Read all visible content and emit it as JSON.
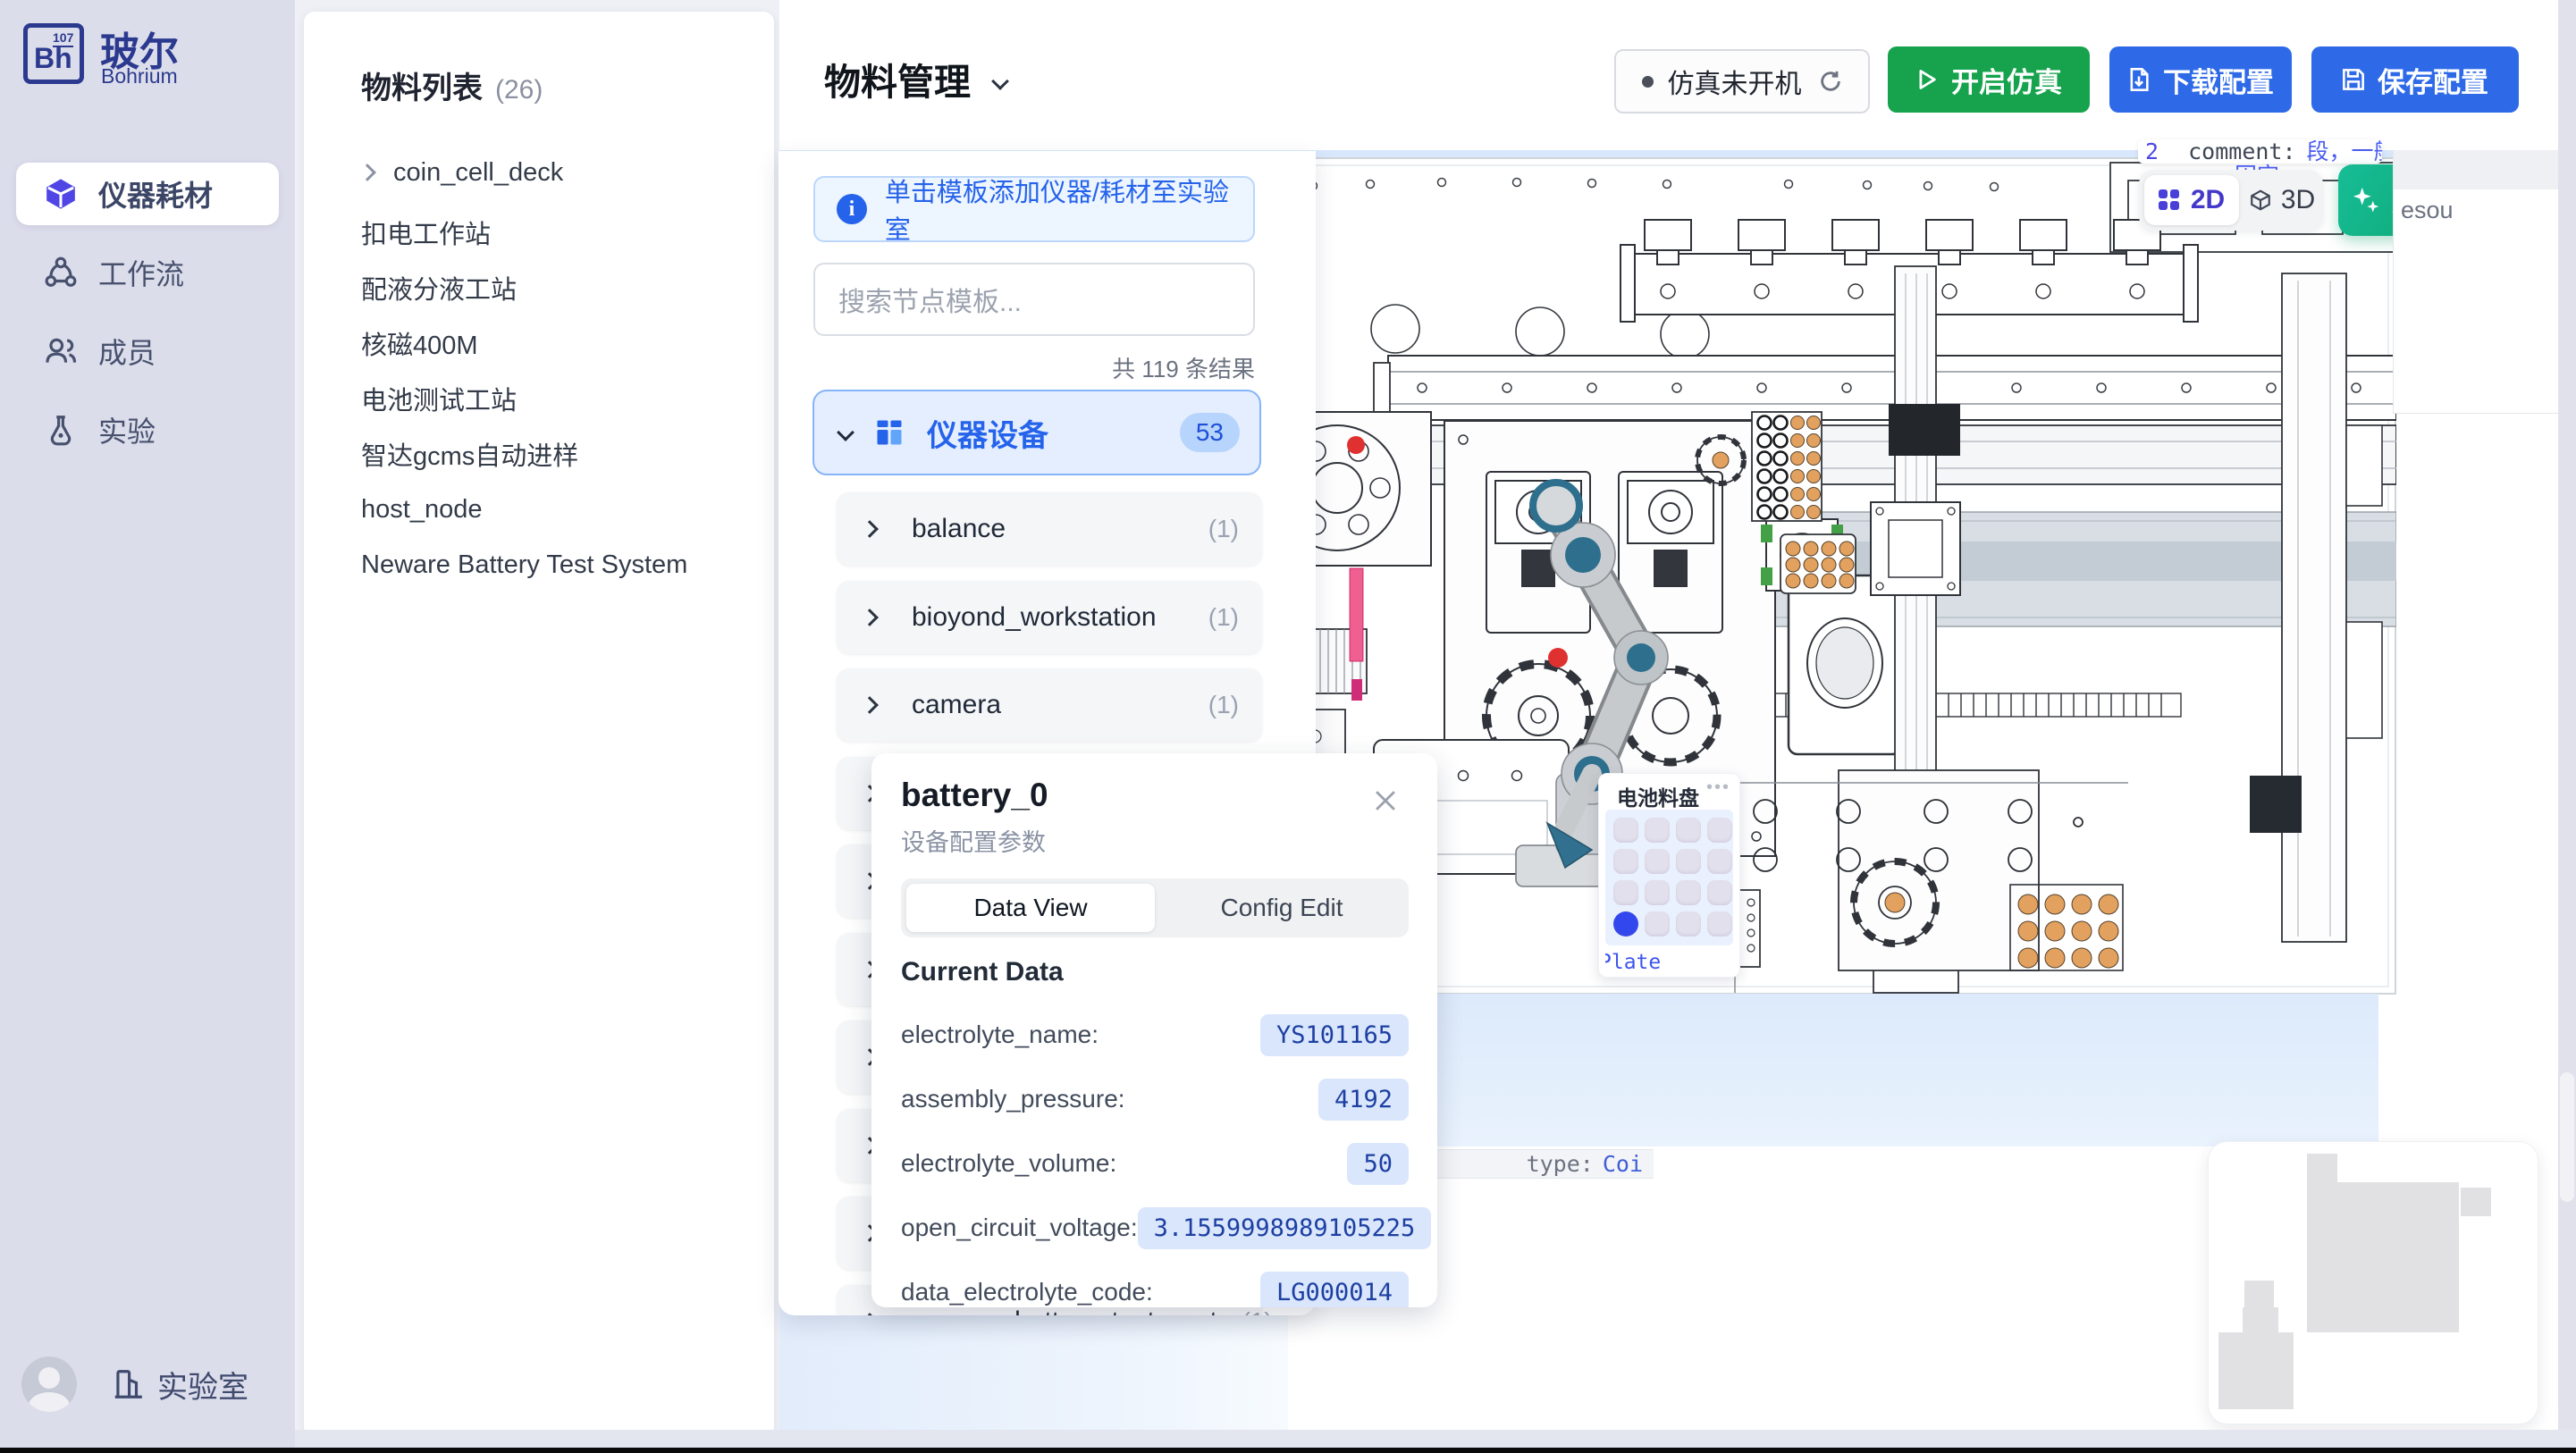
{
  "sidebar": {
    "logo": {
      "symbol": "Bh",
      "number": "107",
      "title": "玻尔",
      "subtitle": "Bohrium"
    },
    "items": [
      {
        "label": "仪器耗材"
      },
      {
        "label": "工作流"
      },
      {
        "label": "成员"
      },
      {
        "label": "实验"
      }
    ],
    "lab_label": "实验室"
  },
  "materials": {
    "title": "物料列表",
    "count": "(26)",
    "items": [
      "coin_cell_deck",
      "扣电工作站",
      "配液分液工站",
      "核磁400M",
      "电池测试工站",
      "智达gcms自动进样",
      "host_node",
      "Neware Battery Test System"
    ]
  },
  "header": {
    "title": "物料管理",
    "status": "仿真未开机",
    "start": "开启仿真",
    "download": "下载配置",
    "save": "保存配置"
  },
  "template": {
    "banner": "单击模板添加仪器/耗材至实验室",
    "search_placeholder": "搜索节点模板...",
    "result_count": "共 119 条结果",
    "category": {
      "label": "仪器设备",
      "badge": "53"
    },
    "items": [
      {
        "label": "balance",
        "count": "(1)"
      },
      {
        "label": "bioyond_workstation",
        "count": "(1)"
      },
      {
        "label": "camera",
        "count": "(1)"
      },
      {
        "label": "characterization_chromatic",
        "count": "(2)"
      },
      {
        "label": "characterization_optic",
        "count": "(1)"
      },
      {
        "label": "communication_devices",
        "count": "(1)"
      },
      {
        "label": "gas_handler",
        "count": "(1)"
      },
      {
        "label": "hotel",
        "count": "(1)"
      },
      {
        "label": "liquid_handler",
        "count": "(4)"
      },
      {
        "label": "neware_battery_test_system",
        "count": "(1)"
      }
    ]
  },
  "canvas": {
    "code_line": {
      "num": "2",
      "key": "_comment:",
      "value": "段，一般为空，stat",
      "line2": "固定"
    },
    "view_toggle": {
      "d2": "2D",
      "d3": "3D"
    },
    "beautify": "美化布局",
    "side_fragment": "esou",
    "type_row": {
      "label": "type:",
      "value": "Coi"
    },
    "tray_widget": {
      "title": "电池料盘",
      "menu": "•••",
      "plate": "Plate"
    }
  },
  "battery": {
    "title": "battery_0",
    "subtitle": "设备配置参数",
    "tabs": [
      "Data View",
      "Config Edit"
    ],
    "section": "Current Data",
    "rows": [
      {
        "label": "electrolyte_name:",
        "value": "YS101165"
      },
      {
        "label": "assembly_pressure:",
        "value": "4192"
      },
      {
        "label": "electrolyte_volume:",
        "value": "50"
      },
      {
        "label": "open_circuit_voltage:",
        "value": "3.1559998989105225"
      },
      {
        "label": "data_electrolyte_code:",
        "value": "LG000014"
      }
    ]
  },
  "colors": {
    "accent": "#2563eb",
    "primary_blue": "#2e6ae8",
    "green": "#17a34d",
    "teal": "#0fae7c",
    "indigo": "#4f46e5",
    "value_bg": "#d9e6fc",
    "value_text": "#1d3fa2",
    "orange": "#e2a15e"
  }
}
